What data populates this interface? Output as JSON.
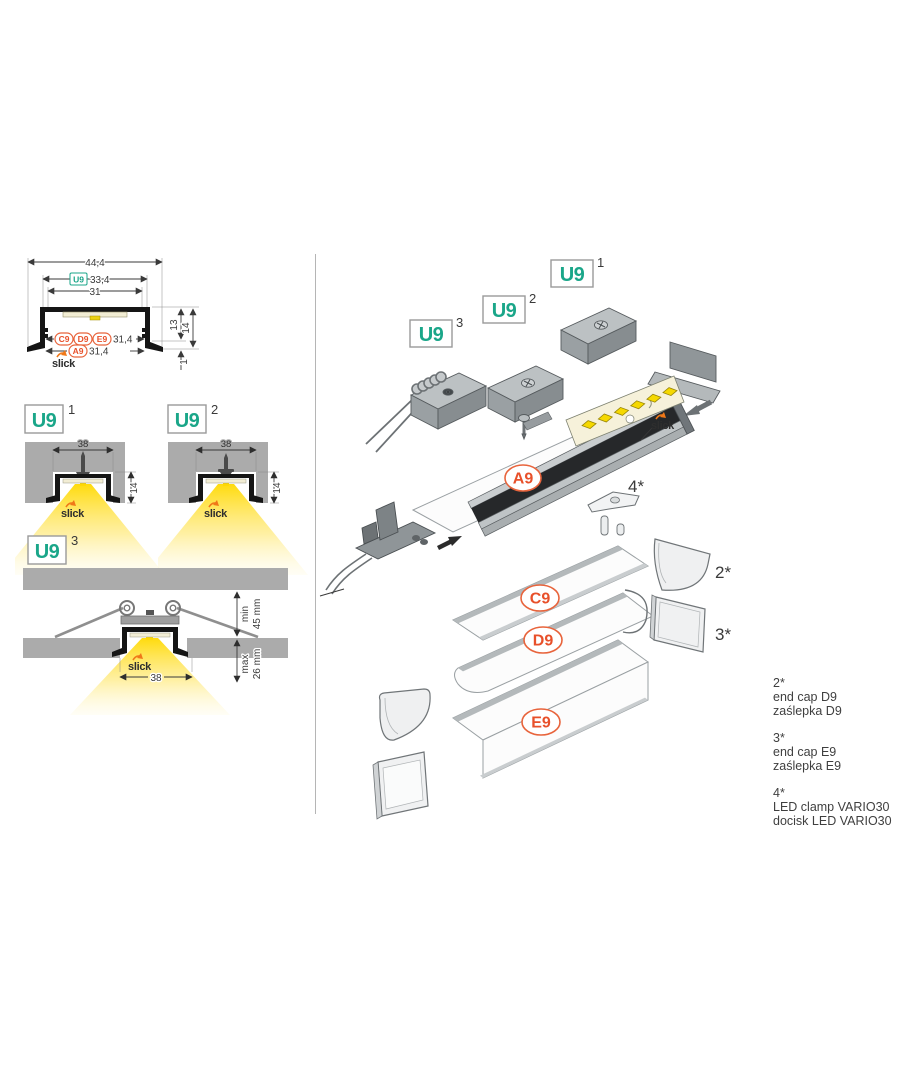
{
  "colors": {
    "teal": "#1AA689",
    "orange": "#E8502A",
    "slick_orange": "#F07818",
    "light_yellow": "#FFDF00",
    "panel_gray": "#ABABAB",
    "profile_black": "#151515",
    "metal_gray": "#9AA0A3",
    "text_dark": "#3A3A3A"
  },
  "cross_section": {
    "dims": {
      "outer_width": "44,4",
      "u9_width": "33,4",
      "inner_width": "31",
      "inner_height": "13",
      "outer_height": "14",
      "flange_height": "1",
      "covers_row_width": "31,4",
      "a9_row_width": "31,4"
    },
    "badges": {
      "u9": "U9",
      "c9": "C9",
      "d9": "D9",
      "e9": "E9",
      "a9": "A9"
    },
    "brand": "slick"
  },
  "mounts": [
    {
      "label": "U9",
      "sup": "1",
      "width": "38",
      "depth": "14",
      "brand": "slick"
    },
    {
      "label": "U9",
      "sup": "2",
      "width": "38",
      "depth": "14",
      "brand": "slick"
    },
    {
      "label": "U9",
      "sup": "3",
      "width": "38",
      "min_label": "min",
      "min_value": "45 mm",
      "max_label": "max",
      "max_value": "26 mm",
      "brand": "slick"
    }
  ],
  "exploded": {
    "badges": [
      {
        "label": "U9",
        "sup": "1"
      },
      {
        "label": "U9",
        "sup": "2"
      },
      {
        "label": "U9",
        "sup": "3"
      }
    ],
    "covers": {
      "a9": "A9",
      "c9": "C9",
      "d9": "D9",
      "e9": "E9"
    },
    "marks": {
      "m2": "2*",
      "m3": "3*",
      "m4": "4*"
    },
    "brand": "slick"
  },
  "legend": [
    {
      "ref": "2*",
      "en": "end cap D9",
      "pl": "zaślepka D9"
    },
    {
      "ref": "3*",
      "en": "end cap E9",
      "pl": "zaślepka E9"
    },
    {
      "ref": "4*",
      "en": "LED clamp VARIO30",
      "pl": "docisk LED VARIO30"
    }
  ]
}
